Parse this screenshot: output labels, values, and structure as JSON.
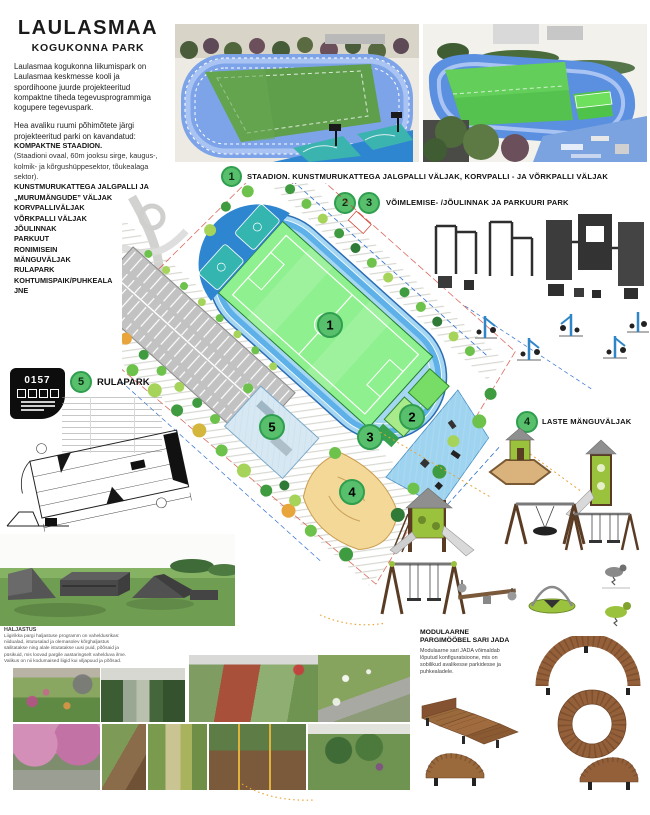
{
  "poster": {
    "title": "LAULASMAA",
    "subtitle": "KOGUKONNA PARK",
    "intro": [
      "Laulasmaa kogukonna liikumispark on Laulasmaa keskmesse kooli ja spordihoone juurde projekteeritud kompaktne tiheda tegevusprogrammiga kogupere tegevuspark.",
      "Hea avaliku ruumi põhimõtete järgi projekteeritud parki on kavandatud:"
    ],
    "program": [
      "KOMPAKTNE STAADION.",
      "(Staadioni ovaal, 60m jooksu sirge, kaugus-, kolmik- ja kõrgushüppesektor, tõukealaga sektor).",
      "KUNSTMURUKATTEGA JALGPALLI JA „MURUMÄNGUDE” VÄLJAK",
      "KORVPALLIVÄLJAK",
      "VÕRKPALLI VÄLJAK",
      "JÕULINNAK",
      "PARKUUT",
      "RONIMISEIN",
      "MÄNGUVÄLJAK",
      "RULAPARK",
      "KOHTUMISPAIK/PUHKEALA",
      "JNE"
    ],
    "badge_code": "0157",
    "sections": [
      {
        "numbers": [
          "1"
        ],
        "title": "STAADION. KUNSTMURUKATTEGA JALGPALLI VÄLJAK, KORVPALLI - JA VÕRKPALLI VÄLJAK"
      },
      {
        "numbers": [
          "2",
          "3"
        ],
        "title": "VÕIMLEMISE- /JÕULINNAK JA PARKUURI PARK"
      },
      {
        "numbers": [
          "4"
        ],
        "title": "LASTE MÄNGUVÄLJAK"
      },
      {
        "numbers": [
          "5"
        ],
        "title": "RULAPARK"
      }
    ],
    "plan": {
      "markers": [
        "1",
        "2",
        "3",
        "4",
        "5"
      ]
    },
    "landscape_note": {
      "title": "HALJASTUS",
      "body": "Liigirikka pargi haljastuse programm on vaheldusrikas: niidualad, istutusalad ja olemasolev kõrghaljastus säilitatakse ning alale istutatakse uusi puid, põõsaid ja püsikuid, mis loovad pargile aastaringselt vahelduva ilme. Valikus on nii kodumaised liigid kui viljapuud ja põõsad."
    },
    "furniture": {
      "title_line1": "MODULAARNE",
      "title_line2": "PARGIMÖÖBEL SARI JADA",
      "body": "Modulaarne sari JADA võimaldab lõputud konfiguratsioone, mis on sobilikud avalikesse parkidesse ja puhkealadele."
    },
    "colors": {
      "marker_green": "#58c06c",
      "marker_ring": "#2f9e4f",
      "track_blue": "#4da3e0",
      "field_green": "#8ef08e",
      "wood_brown": "#8a5a33",
      "equipment_dark": "#3a3a3a",
      "lime": "#9bc23d"
    }
  }
}
